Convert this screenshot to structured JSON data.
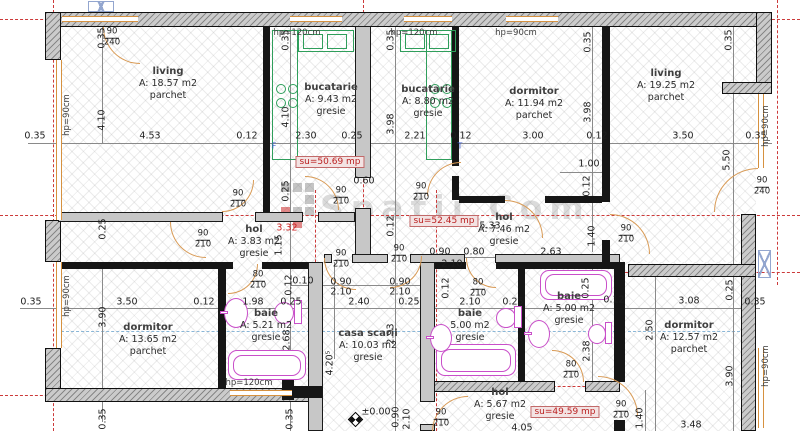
{
  "plan": {
    "watermark": {
      "text": "Spatii Com"
    },
    "level": {
      "text": "±0.00"
    },
    "colors": {
      "wall_fill": "#cbcbcb",
      "wall_line": "#101010",
      "axis_red": "#cc3a3a",
      "window_orange": "#d6913f",
      "kitchen_green": "#2f9e5b",
      "fixture_magenta": "#c94fc9",
      "plumbing_blue": "#8ab6d6",
      "su_red": "#bb2222"
    },
    "rooms": [
      {
        "name": "living",
        "area": "A: 18.57 m2",
        "floor": "parchet",
        "x": 168,
        "y": 66
      },
      {
        "name": "bucatarie",
        "area": "A: 9.43 m2",
        "floor": "gresie",
        "x": 331,
        "y": 82
      },
      {
        "name": "bucatarie",
        "area": "A: 8.80 m2",
        "floor": "gresie",
        "x": 428,
        "y": 84
      },
      {
        "name": "dormitor",
        "area": "A: 11.94 m2",
        "floor": "parchet",
        "x": 534,
        "y": 86
      },
      {
        "name": "living",
        "area": "A: 19.25 m2",
        "floor": "parchet",
        "x": 666,
        "y": 68
      },
      {
        "name": "hol",
        "area": "A: 3.83 m2",
        "floor": "gresie",
        "x": 254,
        "y": 224
      },
      {
        "name": "hol",
        "area": "A: 7.46 m2",
        "floor": "gresie",
        "x": 504,
        "y": 212
      },
      {
        "name": "dormitor",
        "area": "A: 13.65 m2",
        "floor": "parchet",
        "x": 148,
        "y": 322
      },
      {
        "name": "baie",
        "area": "A: 5.21 m2",
        "floor": "gresie",
        "x": 266,
        "y": 308
      },
      {
        "name": "casa scarii",
        "area": "A: 10.03 m2",
        "floor": "gresie",
        "x": 368,
        "y": 328
      },
      {
        "name": "baie",
        "area": "5.00 m2",
        "floor": "gresie",
        "x": 470,
        "y": 308
      },
      {
        "name": "baie",
        "area": "A: 5.00 m2",
        "floor": "gresie",
        "x": 569,
        "y": 291
      },
      {
        "name": "dormitor",
        "area": "A: 12.57 m2",
        "floor": "parchet",
        "x": 689,
        "y": 320
      },
      {
        "name": "hol",
        "area": "A: 5.67 m2",
        "floor": "gresie",
        "x": 500,
        "y": 387
      }
    ],
    "su_labels": [
      {
        "t": "su=50.69 mp",
        "x": 330,
        "y": 162
      },
      {
        "t": "su=52.45 mp",
        "x": 444,
        "y": 221
      },
      {
        "t": "su=49.59 mp",
        "x": 565,
        "y": 412
      }
    ],
    "hp_labels": [
      {
        "t": "hp=90cm",
        "x": 67,
        "y": 115,
        "v": 1
      },
      {
        "t": "hp=90cm",
        "x": 67,
        "y": 296,
        "v": 1
      },
      {
        "t": "hp=120cm",
        "x": 297,
        "y": 33
      },
      {
        "t": "hp=120cm",
        "x": 414,
        "y": 33
      },
      {
        "t": "hp=90cm",
        "x": 516,
        "y": 33
      },
      {
        "t": "hp=90cm",
        "x": 766,
        "y": 126,
        "v": 1
      },
      {
        "t": "hp=90cm",
        "x": 766,
        "y": 366,
        "v": 1
      },
      {
        "t": "hp=120cm",
        "x": 249,
        "y": 383
      }
    ],
    "doors": [
      {
        "t": "90/240",
        "x": 112,
        "y": 38
      },
      {
        "t": "90/210",
        "x": 238,
        "y": 200
      },
      {
        "t": "90/210",
        "x": 203,
        "y": 240
      },
      {
        "t": "90/210",
        "x": 341,
        "y": 197
      },
      {
        "t": "90/210",
        "x": 421,
        "y": 193
      },
      {
        "t": "90/210",
        "x": 626,
        "y": 235
      },
      {
        "t": "90/240",
        "x": 762,
        "y": 187
      },
      {
        "t": "90/210",
        "x": 341,
        "y": 260
      },
      {
        "t": "90/210",
        "x": 399,
        "y": 255
      },
      {
        "t": "80/210",
        "x": 258,
        "y": 281
      },
      {
        "t": "80/210",
        "x": 478,
        "y": 289
      },
      {
        "t": "90/210",
        "x": 441,
        "y": 419
      },
      {
        "t": "90/210",
        "x": 621,
        "y": 411
      },
      {
        "t": "80/210",
        "x": 571,
        "y": 371
      }
    ],
    "letters": [
      {
        "t": "F",
        "x": 274,
        "y": 146
      },
      {
        "t": "T",
        "x": 460,
        "y": 146
      }
    ],
    "dims": [
      {
        "t": "0.35",
        "x": 35,
        "y": 136
      },
      {
        "t": "4.53",
        "x": 150,
        "y": 136
      },
      {
        "t": "0.12",
        "x": 247,
        "y": 136
      },
      {
        "t": "2.30",
        "x": 306,
        "y": 136
      },
      {
        "t": "0.25",
        "x": 352,
        "y": 136
      },
      {
        "t": "2.21",
        "x": 415,
        "y": 136
      },
      {
        "t": "0.12",
        "x": 461,
        "y": 136
      },
      {
        "t": "3.00",
        "x": 533,
        "y": 136
      },
      {
        "t": "0.12",
        "x": 597,
        "y": 136
      },
      {
        "t": "3.50",
        "x": 683,
        "y": 136
      },
      {
        "t": "0.35",
        "x": 756,
        "y": 136
      },
      {
        "t": "0.35",
        "x": 102,
        "y": 38,
        "v": 1
      },
      {
        "t": "4.10",
        "x": 102,
        "y": 120,
        "v": 1
      },
      {
        "t": "0.35",
        "x": 286,
        "y": 40,
        "v": 1
      },
      {
        "t": "4.10",
        "x": 286,
        "y": 117,
        "v": 1
      },
      {
        "t": "0.35",
        "x": 391,
        "y": 40,
        "v": 1
      },
      {
        "t": "3.98",
        "x": 391,
        "y": 124,
        "v": 1
      },
      {
        "t": "0.35",
        "x": 588,
        "y": 42,
        "v": 1
      },
      {
        "t": "3.98",
        "x": 588,
        "y": 112,
        "v": 1
      },
      {
        "t": "0.35",
        "x": 729,
        "y": 40,
        "v": 1
      },
      {
        "t": "5.50",
        "x": 727,
        "y": 160,
        "v": 1
      },
      {
        "t": "0.25",
        "x": 103,
        "y": 229,
        "v": 1
      },
      {
        "t": "0.25",
        "x": 286,
        "y": 191,
        "v": 1
      },
      {
        "t": "0.60",
        "x": 364,
        "y": 181
      },
      {
        "t": "3.32",
        "x": 287,
        "y": 228,
        "red": 1
      },
      {
        "t": "1.15",
        "x": 279,
        "y": 245,
        "v": 1
      },
      {
        "t": "0.12",
        "x": 391,
        "y": 226,
        "v": 1
      },
      {
        "t": "5.33",
        "x": 490,
        "y": 226
      },
      {
        "t": "1.00",
        "x": 589,
        "y": 164
      },
      {
        "t": "0.12",
        "x": 587,
        "y": 186,
        "v": 1
      },
      {
        "t": "1.40",
        "x": 592,
        "y": 236,
        "v": 1
      },
      {
        "t": "2.63",
        "x": 551,
        "y": 252
      },
      {
        "t": "0.90",
        "x": 440,
        "y": 252
      },
      {
        "t": "0.80",
        "x": 474,
        "y": 252
      },
      {
        "t": "2.10",
        "x": 452,
        "y": 264
      },
      {
        "t": "0.35",
        "x": 31,
        "y": 302
      },
      {
        "t": "3.50",
        "x": 127,
        "y": 302
      },
      {
        "t": "0.12",
        "x": 204,
        "y": 302
      },
      {
        "t": "1.98",
        "x": 253,
        "y": 302
      },
      {
        "t": "0.25",
        "x": 291,
        "y": 302
      },
      {
        "t": "2.40",
        "x": 359,
        "y": 302
      },
      {
        "t": "0.25",
        "x": 409,
        "y": 302
      },
      {
        "t": "2.10",
        "x": 470,
        "y": 302
      },
      {
        "t": "0.25",
        "x": 513,
        "y": 302
      },
      {
        "t": "0.12",
        "x": 614,
        "y": 300
      },
      {
        "t": "3.08",
        "x": 689,
        "y": 301
      },
      {
        "t": "0.35",
        "x": 755,
        "y": 302
      },
      {
        "t": "0.10",
        "x": 303,
        "y": 281
      },
      {
        "t": "0.90",
        "x": 341,
        "y": 282
      },
      {
        "t": "2.10",
        "x": 341,
        "y": 292
      },
      {
        "t": "0.90",
        "x": 400,
        "y": 282
      },
      {
        "t": "2.10",
        "x": 400,
        "y": 292
      },
      {
        "t": "0.12",
        "x": 289,
        "y": 285,
        "v": 1
      },
      {
        "t": "0.12",
        "x": 446,
        "y": 288,
        "v": 1
      },
      {
        "t": "0.25",
        "x": 586,
        "y": 288,
        "v": 1
      },
      {
        "t": "3.90",
        "x": 103,
        "y": 317,
        "v": 1
      },
      {
        "t": "0.35",
        "x": 103,
        "y": 419,
        "v": 1
      },
      {
        "t": "2.68",
        "x": 287,
        "y": 340,
        "v": 1
      },
      {
        "t": "2.93",
        "x": 391,
        "y": 334,
        "v": 1
      },
      {
        "t": "4.20⁵",
        "x": 330,
        "y": 363,
        "v": 1
      },
      {
        "t": "0.35",
        "x": 290,
        "y": 419,
        "v": 1
      },
      {
        "t": "0.90",
        "x": 396,
        "y": 417,
        "v": 1
      },
      {
        "t": "2.10",
        "x": 407,
        "y": 419,
        "v": 1
      },
      {
        "t": "2.38",
        "x": 587,
        "y": 351,
        "v": 1
      },
      {
        "t": "2.50",
        "x": 650,
        "y": 330,
        "v": 1
      },
      {
        "t": "0.25",
        "x": 730,
        "y": 290,
        "v": 1
      },
      {
        "t": "3.90",
        "x": 730,
        "y": 376,
        "v": 1
      },
      {
        "t": "1.40",
        "x": 640,
        "y": 418,
        "v": 1
      },
      {
        "t": "3.48",
        "x": 691,
        "y": 425
      },
      {
        "t": "4.05",
        "x": 522,
        "y": 428
      }
    ]
  }
}
